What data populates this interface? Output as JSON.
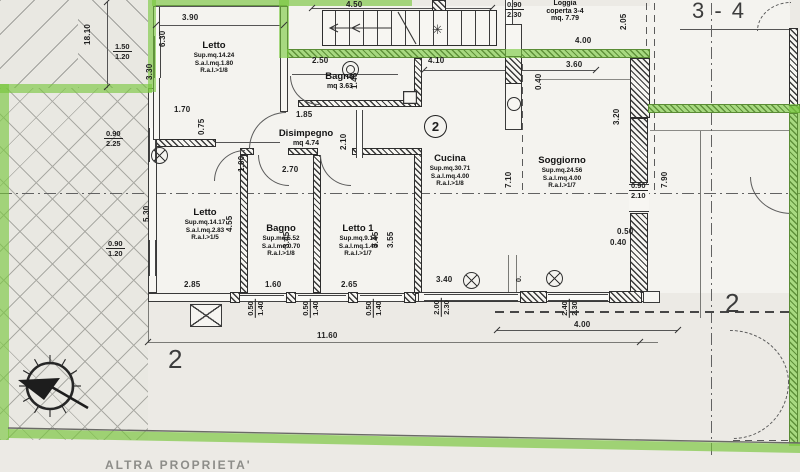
{
  "labels": {
    "unit_top_right": "3 - 4",
    "unit_bottom_left": "2",
    "unit_bottom_right": "2",
    "kitchen_circle": "2",
    "bottom_edge_text": "ALTRA PROPRIETA'"
  },
  "loggia": {
    "l1": "Loggia",
    "l2": "coperta 3-4",
    "l3": "mq. 7.79"
  },
  "rooms": [
    {
      "name": "Letto",
      "l1": "Sup.mq.14.24",
      "l2": "S.a.l.mq.1.80",
      "l3": "R.a.I.>1/8"
    },
    {
      "name": "Bagno",
      "l1": "mq 3.63"
    },
    {
      "name": "Disimpegno",
      "l1": "mq 4.74"
    },
    {
      "name": "Cucina",
      "l1": "Sup.mq.30.71",
      "l2": "S.a.l.mq.4.00",
      "l3": "R.a.I.>1/8"
    },
    {
      "name": "Soggiorno",
      "l1": "Sup.mq.24.56",
      "l2": "S.a.l.mq.4.00",
      "l3": "R.a.I.>1/7"
    },
    {
      "name": "Letto",
      "l1": "Sup.mq.14.17",
      "l2": "S.a.l.mq.2.83",
      "l3": "R.a.I.>1/5"
    },
    {
      "name": "Bagno",
      "l1": "Sup.mq.5.52",
      "l2": "S.a.l.mq.0.70",
      "l3": "R.a.I.>1/8"
    },
    {
      "name": "Letto 1",
      "l1": "Sup.mq.9.14",
      "l2": "S.a.l.mq.1.40",
      "l3": "R.a.I.>1/7"
    }
  ],
  "dims": [
    "18.10",
    "3.90",
    "6.30",
    "3.30",
    "4.50",
    "2.50",
    "4.10",
    "1.45",
    "1.70",
    "0.75",
    "1.85",
    "2.10",
    "1.00",
    "2.70",
    "5.30",
    "4.55",
    "3.45",
    "3.45",
    "3.55",
    "7.10",
    "3.60",
    "0.40",
    "4.00",
    "2.05",
    "3.20",
    "7.90",
    "0.50",
    "0.40",
    "3.40",
    "2.85",
    "1.60",
    "2.65",
    "11.60",
    "4.00",
    "0."
  ],
  "fracs": [
    [
      "1.50",
      "1.20"
    ],
    [
      "0.90",
      "2.25"
    ],
    [
      "0.90",
      "1.20"
    ],
    [
      "0.90",
      "2.30"
    ],
    [
      "0.90",
      "2.10"
    ],
    [
      "0.50",
      "1.40"
    ],
    [
      "0.50",
      "1.40"
    ],
    [
      "0.50",
      "1.40"
    ],
    [
      "2.00",
      "2.30"
    ],
    [
      "2.40",
      "2.30"
    ]
  ],
  "symbols": {
    "star": "✳"
  },
  "colors": {
    "boundary_green": "#76c63a",
    "ink": "#2d2d2d",
    "paper": "#eceae5"
  }
}
